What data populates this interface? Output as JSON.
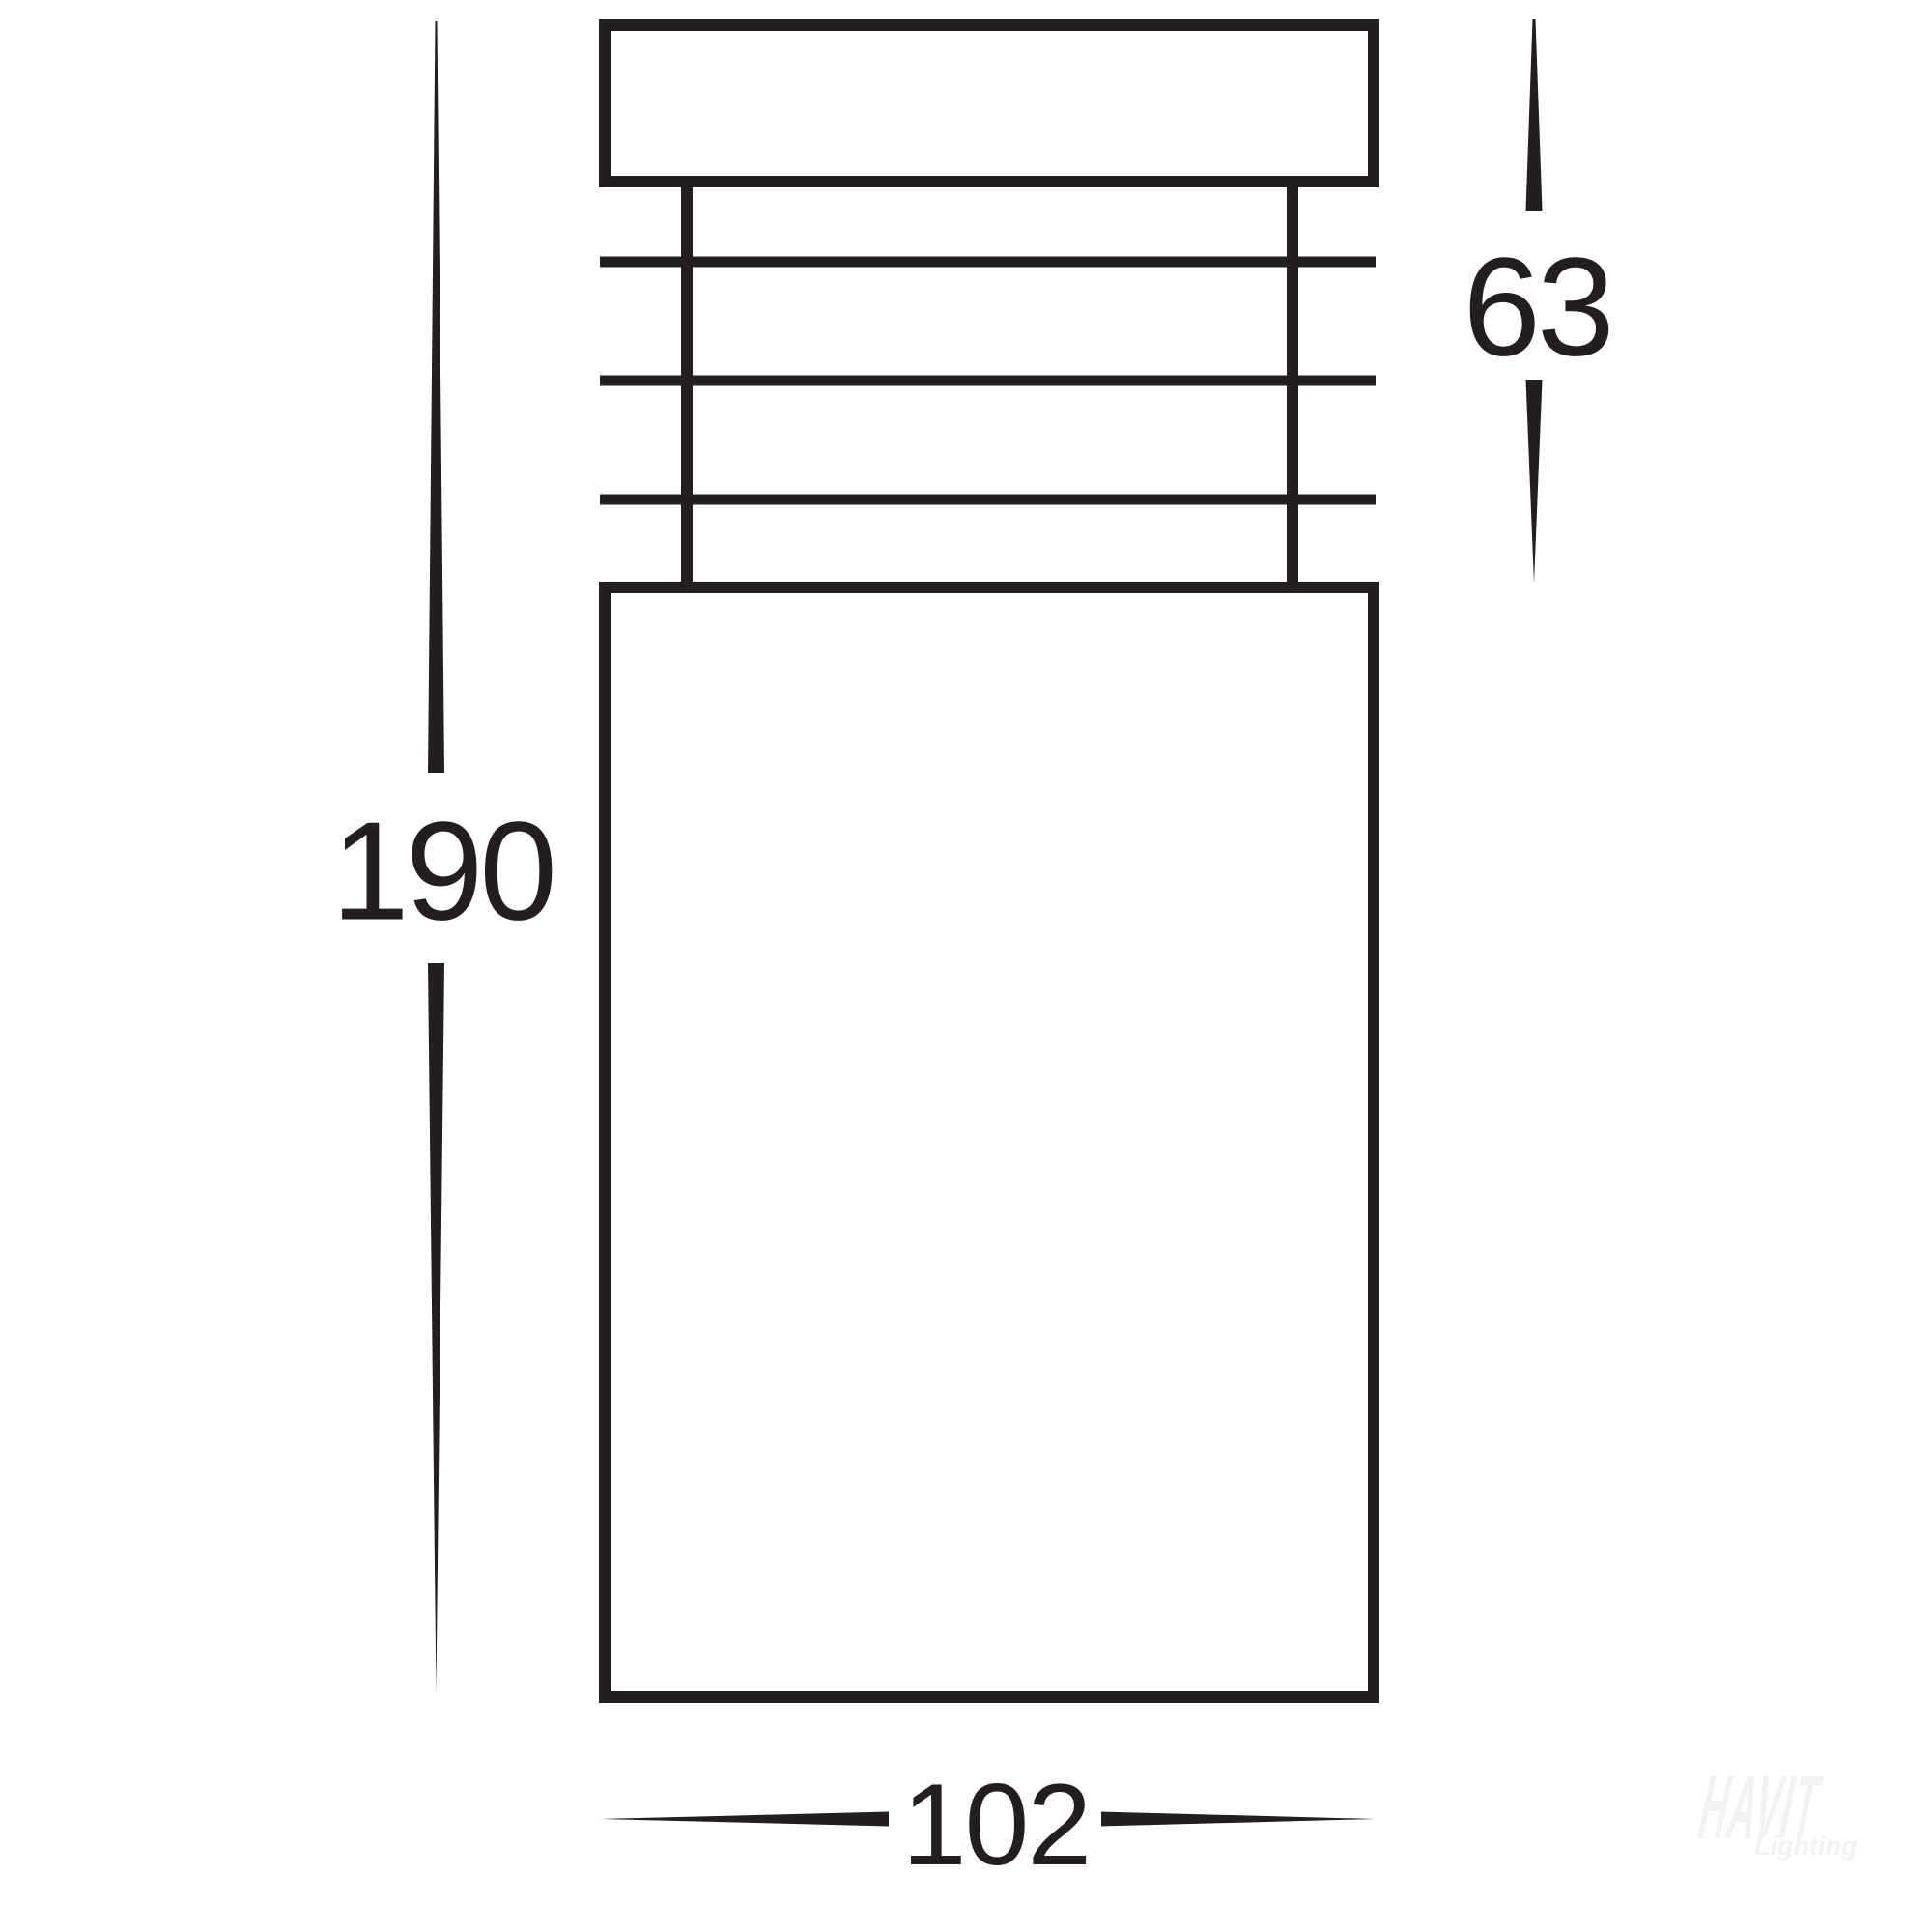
{
  "drawing": {
    "line_color": "#231f20",
    "labels": {
      "overall_height": "190",
      "head_height": "63",
      "width": "102"
    },
    "watermark": {
      "brand": "HAVIT",
      "tagline": "Lighting",
      "color": "#f2f2f2"
    }
  }
}
